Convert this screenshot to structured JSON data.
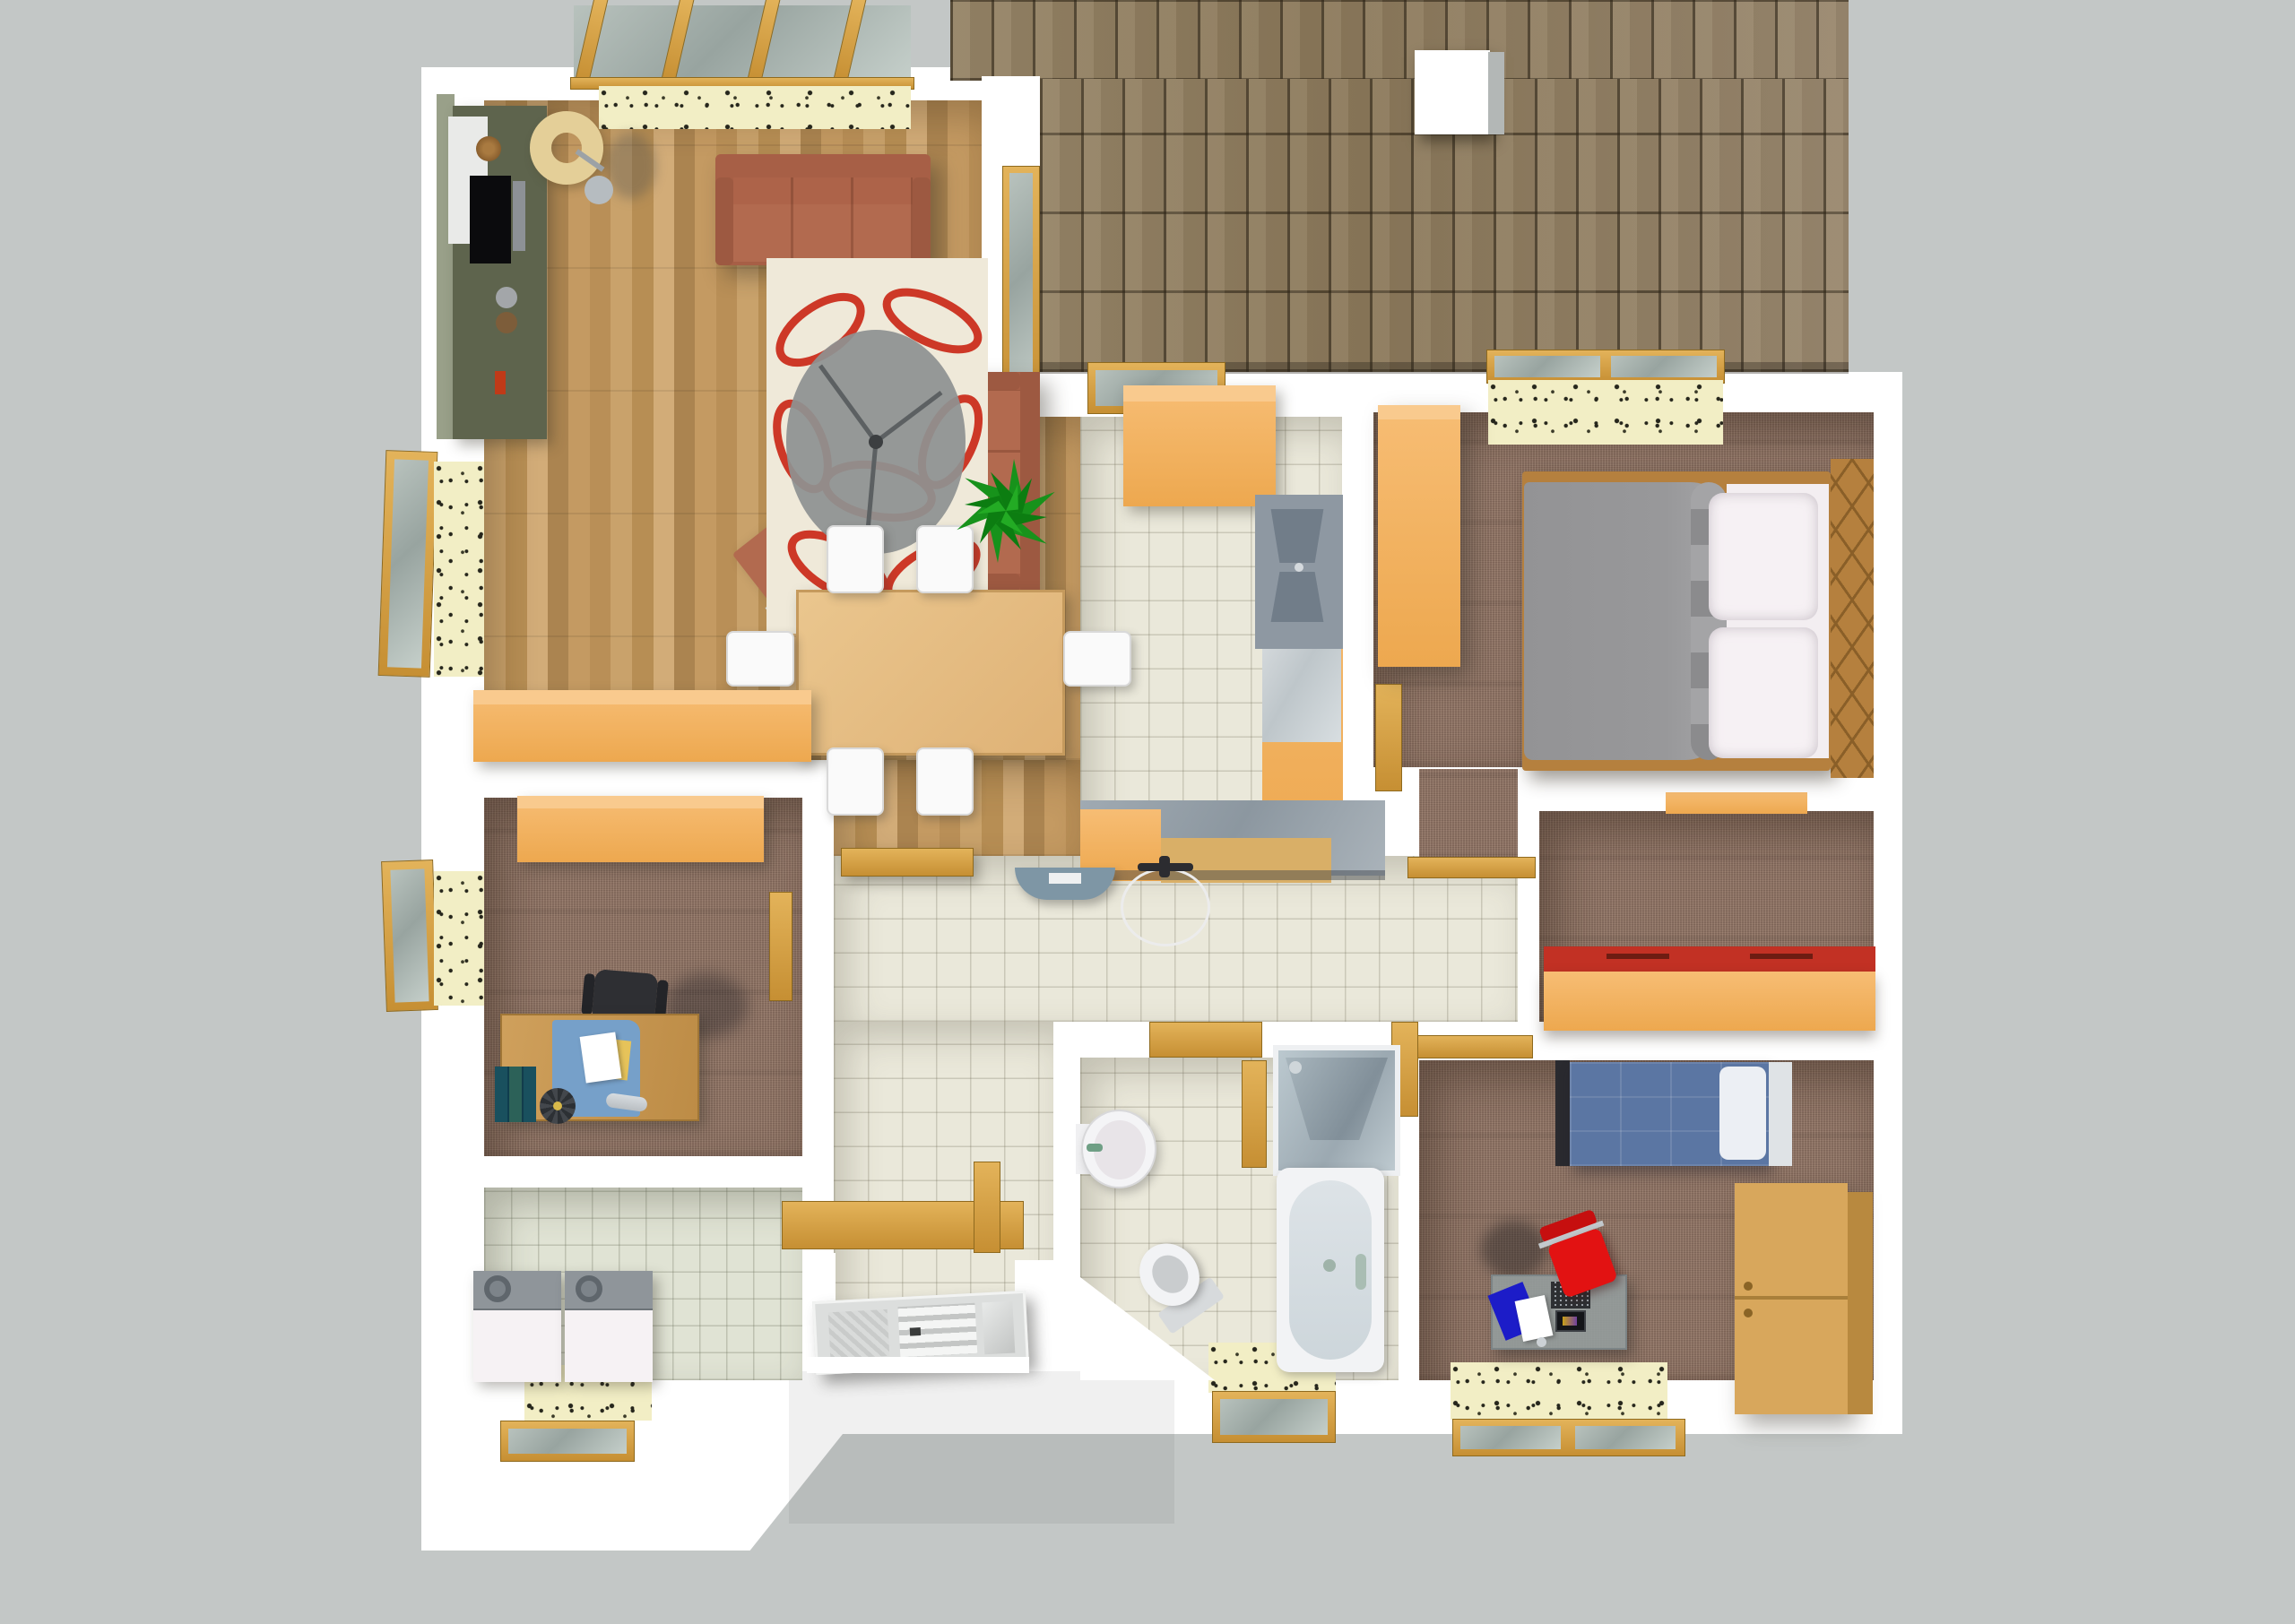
{
  "scene": {
    "title": "3D floor plan — top-down view of a single-storey house",
    "background": "#c3c7c6"
  },
  "palette": {
    "background_gray": "#c3c7c6",
    "wall_white": "#ffffff",
    "roof_brown": "#8d7c60",
    "wood_floor": "#c19a63",
    "tile_floor": "#eae8da",
    "utility_tile": "#e0e3d4",
    "carpet_brown": "#8d7365",
    "window_sill_speckled": "#f2eec5",
    "window_frame_gold": "#d8a848",
    "cabinet_orange": "#f5b768",
    "sofa_terracotta": "#b26a4f",
    "rug_cream": "#efe9d9",
    "rug_red": "#cb2a18",
    "bed_blanket_gray": "#98989a",
    "kids_bed_blue": "#5b76a3",
    "bench_red": "#c23124",
    "desk_wood": "#c89a54",
    "fixture_white": "#f2f3f5",
    "plant_green": "#1b9a1e"
  },
  "rooms": [
    {
      "id": "living-room",
      "label": "Living room",
      "floor": "oak parquet"
    },
    {
      "id": "dining-area",
      "label": "Dining area",
      "floor": "oak parquet"
    },
    {
      "id": "kitchen",
      "label": "Kitchen",
      "floor": "cream tile"
    },
    {
      "id": "hallway",
      "label": "Hallway",
      "floor": "cream tile"
    },
    {
      "id": "office",
      "label": "Office",
      "floor": "brown carpet"
    },
    {
      "id": "utility-room",
      "label": "Utility room",
      "floor": "green-grey tile"
    },
    {
      "id": "bathroom",
      "label": "Bathroom",
      "floor": "cream tile"
    },
    {
      "id": "master-bedroom",
      "label": "Master bedroom",
      "floor": "brown carpet"
    },
    {
      "id": "guest-room",
      "label": "Guest room",
      "floor": "brown carpet"
    },
    {
      "id": "kids-room",
      "label": "Kids room",
      "floor": "brown carpet"
    }
  ],
  "furniture": {
    "living": [
      "Media wall unit",
      "Television",
      "Floor lamp",
      "Three-seat sofa",
      "Two-seat sofa",
      "Armchair",
      "Patterned rug with glass coffee table",
      "Sideboard",
      "Potted plant"
    ],
    "dining": [
      "Dining table",
      "White chair",
      "Hall bench"
    ],
    "kitchen": [
      "Upper cabinet block",
      "Tall cabinet run",
      "Sink counter",
      "Island counter",
      "Ceiling lamp",
      "Wire pendant lamp"
    ],
    "office": [
      "Wardrobe",
      "Writing desk",
      "Office chair",
      "Books",
      "Desk fan"
    ],
    "utility": [
      "Washing machine",
      "Tumble dryer"
    ],
    "bathroom": [
      "Shower cabin",
      "Bathtub",
      "Wash basin",
      "Toilet"
    ],
    "master": [
      "Wardrobe",
      "Double bed",
      "Pillows",
      "Lattice headboard"
    ],
    "guest": [
      "Daybed with red cushion",
      "Window shelf"
    ],
    "kids": [
      "Single bed",
      "Pillow",
      "Tall cabinet",
      "Glass desk with laptop",
      "Red desk chair"
    ]
  },
  "exterior": {
    "roof": "Shingled roof surface",
    "chimney": "White chimney",
    "pergola": "Beamed glass roof over terrace window",
    "front_door": "Panelled front door",
    "porch": "Entrance porch",
    "casement_windows": "Golden open casement windows with speckled stone sills"
  }
}
